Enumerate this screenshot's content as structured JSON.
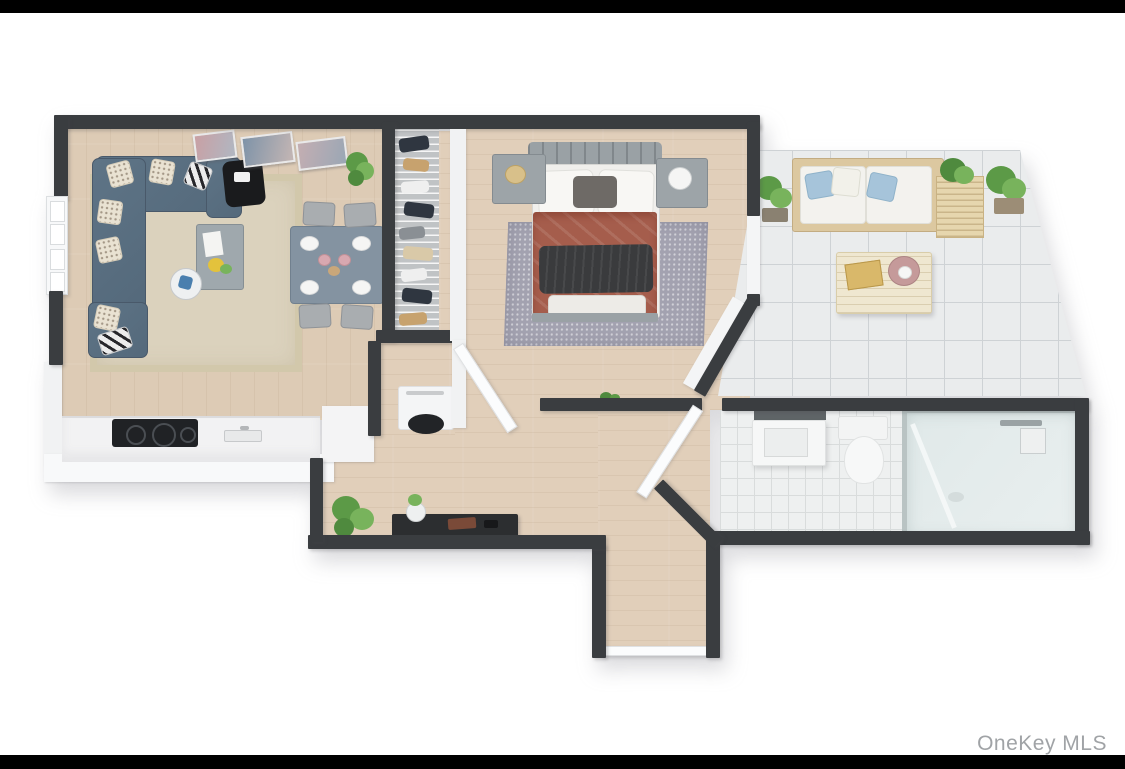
{
  "watermark": {
    "text": "OneKey MLS"
  },
  "palette": {
    "background": "#ffffff",
    "letterbox_bar": "#000000",
    "wall": "#3a3d40",
    "wood_floor_living": "#ddcbb5",
    "wood_floor_warm": "#e1cfba",
    "patio_tile": "#eaeced",
    "bath_tile": "#eef0f0",
    "living_rug": "#dbd2bd",
    "bedroom_rug": "#a3a2b0",
    "sofa_blue": "#5a7082",
    "duvet_terracotta": "#a55d4c",
    "throw_dark": "#3a3b3d",
    "dining_table": "#8493a1",
    "kitchen_counter": "#f2f2f3",
    "cooktop": "#202225",
    "plant_green": "#6aa84f",
    "watermark_text": "#a0a3a6"
  },
  "scene": {
    "type": "3d-floor-plan",
    "description": "Top-down 3D rendered floor plan of a one-bedroom apartment with terrace",
    "rooms": [
      {
        "name": "living-dining-kitchen",
        "floor": "wood",
        "contents": [
          "sectional-sofa",
          "throw-pillows",
          "coffee-table",
          "side-table",
          "black-accent-chair",
          "area-rug",
          "dining-table",
          "dining-chairs",
          "place-settings",
          "wall-art-frames",
          "potted-plant",
          "window",
          "kitchen-counter",
          "cooktop",
          "kitchen-sink"
        ]
      },
      {
        "name": "closet",
        "floor": "wood",
        "contents": [
          "wire-shelving",
          "hanging-clothes",
          "washer"
        ]
      },
      {
        "name": "bedroom",
        "floor": "wood",
        "contents": [
          "double-bed",
          "headboard",
          "white-pillows",
          "dark-accent-pillow",
          "terracotta-duvet",
          "dark-throw-blanket",
          "folded-foot-blanket",
          "nightstand-left",
          "nightstand-right",
          "table-lamp",
          "dotted-area-rug"
        ]
      },
      {
        "name": "terrace",
        "floor": "white-tile",
        "contents": [
          "outdoor-sofa",
          "blue-pillows",
          "slatted-side-table",
          "outdoor-coffee-table",
          "gold-tray",
          "pink-round-tray",
          "potted-plants"
        ]
      },
      {
        "name": "bathroom",
        "floor": "white-tile",
        "contents": [
          "vanity-sink",
          "toilet",
          "glass-shower",
          "shower-fixtures",
          "open-door"
        ]
      },
      {
        "name": "hallway-entry",
        "floor": "wood",
        "contents": [
          "potted-plant",
          "dark-console-table",
          "flower-vase",
          "open-doors",
          "entry-corridor"
        ]
      }
    ]
  }
}
